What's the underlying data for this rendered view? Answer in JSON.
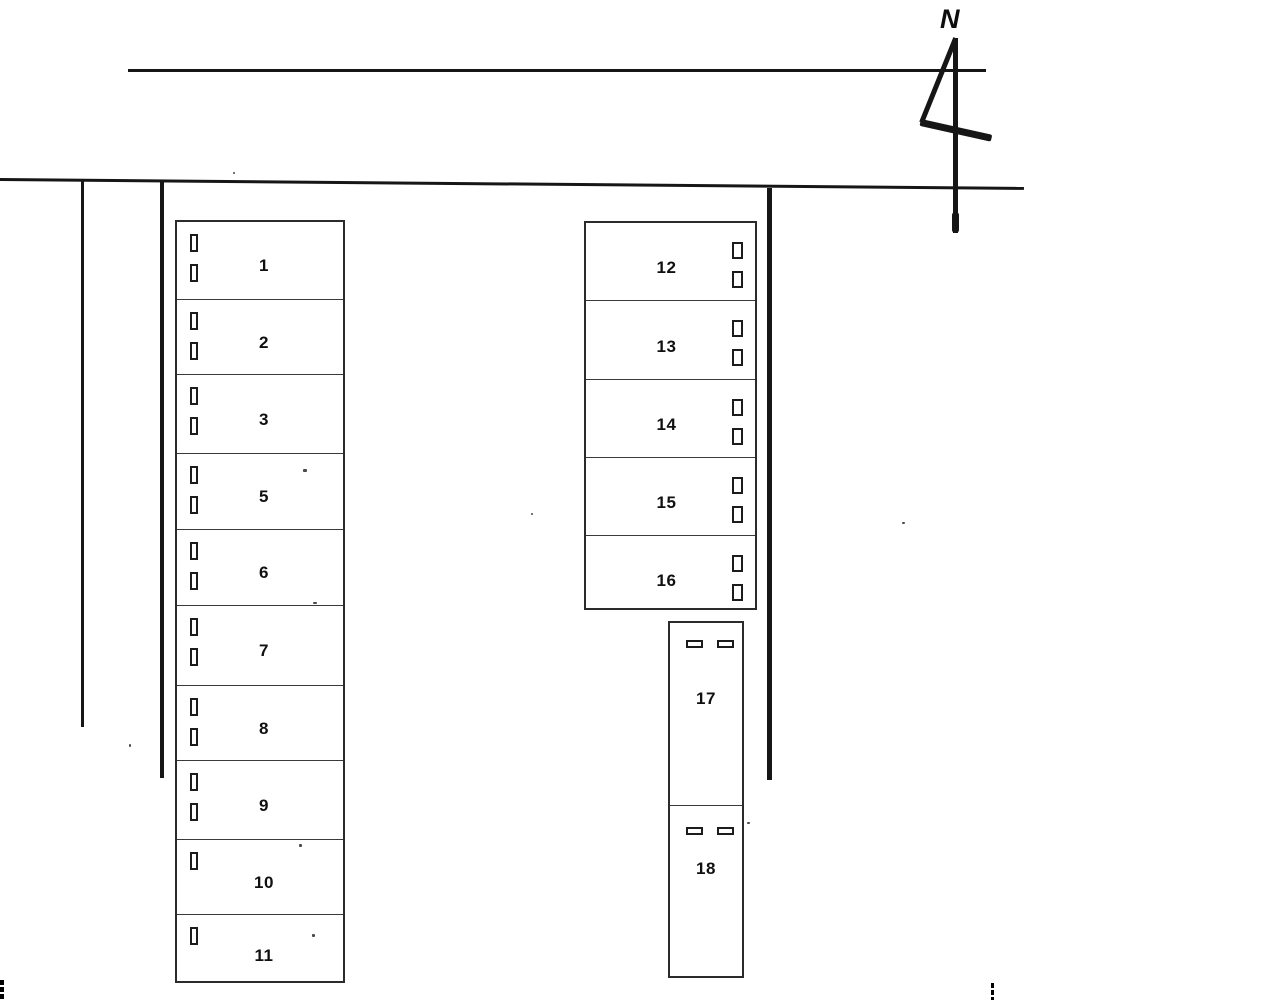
{
  "compass": {
    "label": "N"
  },
  "blocks": {
    "left_column": {
      "units": [
        {
          "label": "1",
          "doors": 2
        },
        {
          "label": "2",
          "doors": 2
        },
        {
          "label": "3",
          "doors": 2
        },
        {
          "label": "5",
          "doors": 2
        },
        {
          "label": "6",
          "doors": 2
        },
        {
          "label": "7",
          "doors": 2
        },
        {
          "label": "8",
          "doors": 2
        },
        {
          "label": "9",
          "doors": 2
        },
        {
          "label": "10",
          "doors": 1
        },
        {
          "label": "11",
          "doors": 1
        }
      ]
    },
    "right_column": {
      "units": [
        {
          "label": "12",
          "doors": 2
        },
        {
          "label": "13",
          "doors": 2
        },
        {
          "label": "14",
          "doors": 2
        },
        {
          "label": "15",
          "doors": 2
        },
        {
          "label": "16",
          "doors": 2
        }
      ]
    },
    "lower_column": {
      "units": [
        {
          "label": "17",
          "doors": 2
        },
        {
          "label": "18",
          "doors": 2
        }
      ]
    }
  },
  "colors": {
    "ink": "#101010",
    "line": "#161616"
  }
}
